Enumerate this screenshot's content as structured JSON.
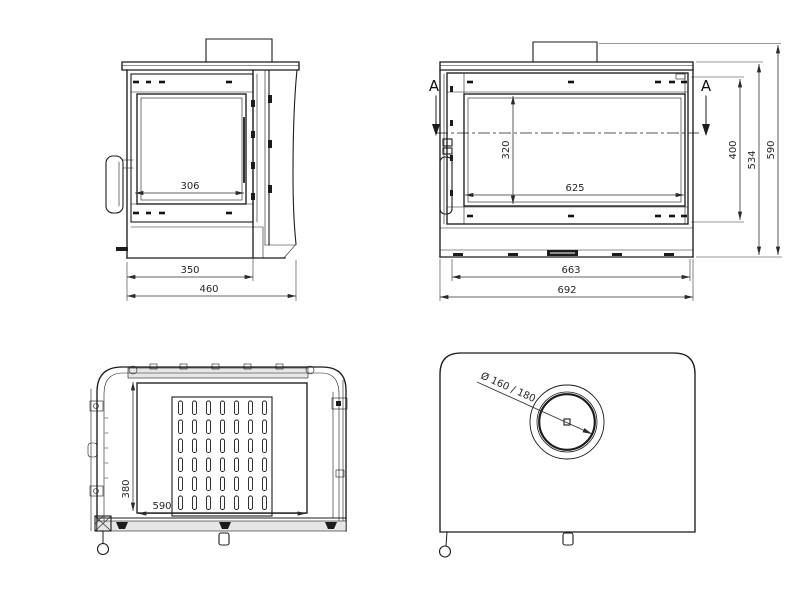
{
  "drawing": {
    "background_color": "#ffffff",
    "line_color": "#1c1c1c",
    "views": {
      "side_view": {
        "dimensions": {
          "glass_width": "306",
          "body_depth": "350",
          "overall_depth": "460"
        }
      },
      "front_view": {
        "section_marker_left": "A",
        "section_marker_right": "A",
        "dimensions": {
          "glass_height": "320",
          "glass_width": "625",
          "firebox_height": "400",
          "body_height": "534",
          "overall_height": "590",
          "inner_width": "663",
          "overall_width": "692"
        }
      },
      "top_view_interior": {
        "dimensions": {
          "chamber_depth": "380",
          "chamber_width": "590"
        }
      },
      "top_view_exterior": {
        "dimensions": {
          "flue_diameter": "Ø 160 / 180"
        }
      }
    }
  }
}
